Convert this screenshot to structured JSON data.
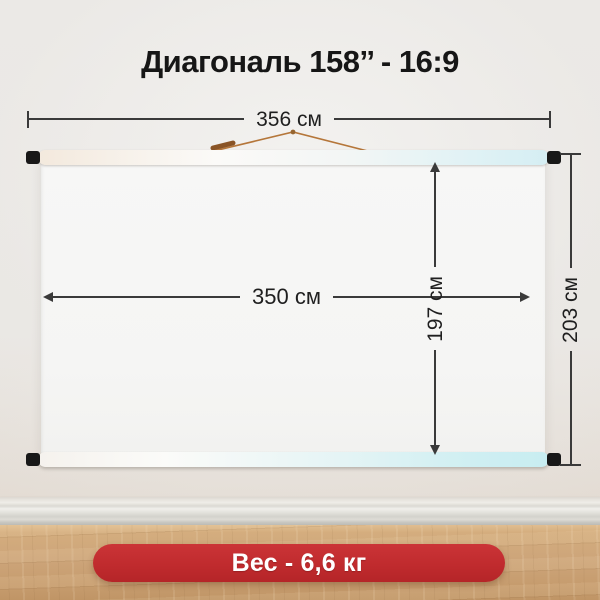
{
  "title": "Диагональ 158’’ - 16:9",
  "dimensions": {
    "top_width": "356 см",
    "screen_width": "350 см",
    "screen_height": "197 см",
    "total_height": "203 см"
  },
  "weight_badge": "Вес - 6,6 кг",
  "colors": {
    "badge_red": "#c02b2e",
    "badge_text": "#ffffff",
    "dimension_line": "#3a3a3a",
    "title_text": "#161616",
    "cord_orange": "#b5763a",
    "bar_cyan_tint": "#d5eef3",
    "floor_wood": "#cda57a",
    "wall": "#e9e6e2"
  }
}
